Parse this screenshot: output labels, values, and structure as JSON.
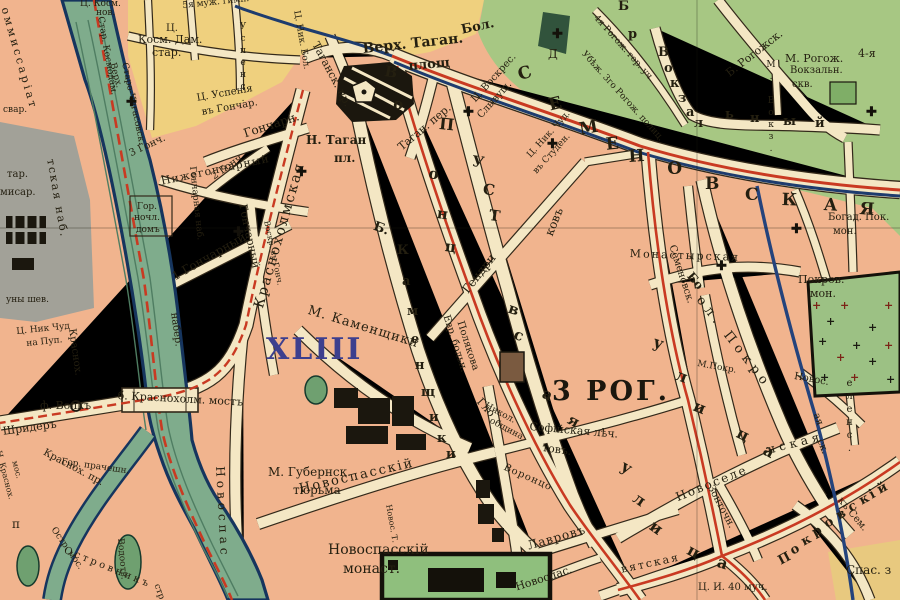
{
  "map_type": "historical city map (Moscow, Taganka area, pre-1917 orthography)",
  "districts": {
    "xliii": "XLIII",
    "rog3": "3 РОГ."
  },
  "icons": {
    "church": "✚",
    "plus": "+"
  },
  "palette": {
    "block_pink": "#F1B48E",
    "street_cream": "#F4E7C4",
    "field_yellow": "#EFD07E",
    "green_area": "#A7C783",
    "grey_area": "#A2A198",
    "water": "#7FAC8C",
    "water_edge": "#16355E",
    "tram_red": "#C93A22",
    "line_blue": "#1E3C6E",
    "building_black": "#1b170e",
    "hospital_brown": "#7a5a40",
    "district_blue": "#3d3f8e"
  },
  "labels": [
    {
      "t": "оммиссаріат",
      "x": 10,
      "y": 6,
      "r": 74,
      "s": 11,
      "ls": 3
    },
    {
      "t": "тская наб.",
      "x": 56,
      "y": 158,
      "r": 80,
      "s": 11,
      "ls": 2
    },
    {
      "t": "свар.",
      "x": 3,
      "y": 106,
      "s": 9
    },
    {
      "t": "тар.",
      "x": 7,
      "y": 170,
      "s": 10
    },
    {
      "t": "мисар.",
      "x": 0,
      "y": 188,
      "s": 10
    },
    {
      "t": "уны шев.",
      "x": 6,
      "y": 296,
      "s": 9
    },
    {
      "t": "Ц. Ник Чуд",
      "x": 16,
      "y": 328,
      "r": -6,
      "s": 9
    },
    {
      "t": "на Пуп.",
      "x": 26,
      "y": 340,
      "r": -6,
      "s": 9
    },
    {
      "t": "ф. Волкъ",
      "x": 40,
      "y": 400,
      "s": 11
    },
    {
      "t": "Шридеръ",
      "x": 2,
      "y": 426,
      "r": -8,
      "s": 11
    },
    {
      "t": "Краснох.",
      "x": 76,
      "y": 328,
      "r": 82,
      "s": 10
    },
    {
      "t": "набер.",
      "x": 178,
      "y": 312,
      "r": 82,
      "s": 10
    },
    {
      "t": "б. Краснохолм. мостъ",
      "x": 118,
      "y": 390,
      "r": 3,
      "s": 11
    },
    {
      "t": "Н. Краснох.",
      "x": 2,
      "y": 450,
      "r": 75,
      "s": 8
    },
    {
      "t": "мос.",
      "x": 18,
      "y": 460,
      "r": 75,
      "s": 8
    },
    {
      "t": "Краснох. пр.",
      "x": 46,
      "y": 448,
      "r": 28,
      "s": 10
    },
    {
      "t": "Гор. прачешн.",
      "x": 62,
      "y": 458,
      "r": 8,
      "s": 9
    },
    {
      "t": "Остр. мос.",
      "x": 56,
      "y": 526,
      "r": 55,
      "s": 9
    },
    {
      "t": "Островникъ",
      "x": 66,
      "y": 546,
      "r": 22,
      "s": 10,
      "ls": 3
    },
    {
      "t": "стр",
      "x": 160,
      "y": 583,
      "r": 70,
      "s": 9
    },
    {
      "t": "п",
      "x": 12,
      "y": 518,
      "s": 12
    },
    {
      "t": "Водоотв.",
      "x": 124,
      "y": 538,
      "r": 85,
      "s": 9
    },
    {
      "t": "Новоспас",
      "x": 226,
      "y": 466,
      "r": 87,
      "s": 12,
      "ls": 4
    },
    {
      "t": "Ц. Косм.",
      "x": 80,
      "y": 0,
      "s": 9
    },
    {
      "t": "нов.",
      "x": 96,
      "y": 9,
      "s": 9
    },
    {
      "t": "Стар. Космодам.",
      "x": 104,
      "y": 16,
      "r": 80,
      "s": 9
    },
    {
      "t": "Ц.",
      "x": 166,
      "y": 24,
      "s": 10
    },
    {
      "t": "Косм. Дам.",
      "x": 138,
      "y": 34,
      "s": 11
    },
    {
      "t": "стар.",
      "x": 152,
      "y": 47,
      "s": 11
    },
    {
      "t": "5я муж. гимн.",
      "x": 182,
      "y": 2,
      "r": -6,
      "s": 9
    },
    {
      "t": "Успенс.",
      "x": 238,
      "y": 22,
      "s": 9,
      "m": "v"
    },
    {
      "t": "Верх.",
      "x": 116,
      "y": 62,
      "r": 75,
      "s": 9
    },
    {
      "t": "Старо-Чигасовск.",
      "x": 128,
      "y": 62,
      "r": 78,
      "s": 9
    },
    {
      "t": "Ц. Успенія",
      "x": 196,
      "y": 94,
      "r": -10,
      "s": 10
    },
    {
      "t": "въ Гончар.",
      "x": 201,
      "y": 108,
      "r": -10,
      "s": 10
    },
    {
      "t": "Гончарн.",
      "x": 242,
      "y": 128,
      "r": -18,
      "s": 12
    },
    {
      "t": "Нижегончарный",
      "x": 160,
      "y": 176,
      "r": -12,
      "s": 11,
      "ls": 1
    },
    {
      "t": "2 Гонч",
      "x": 210,
      "y": 174,
      "r": -35,
      "s": 10
    },
    {
      "t": "1 Гончарный",
      "x": 170,
      "y": 272,
      "r": -30,
      "s": 12
    },
    {
      "t": "Гончарный",
      "x": 248,
      "y": 203,
      "r": 78,
      "s": 11
    },
    {
      "t": "Гончарная наб.",
      "x": 196,
      "y": 166,
      "r": 84,
      "s": 9
    },
    {
      "t": "Гор.",
      "x": 137,
      "y": 203,
      "s": 9
    },
    {
      "t": "ночл.",
      "x": 134,
      "y": 214,
      "s": 9
    },
    {
      "t": "домъ",
      "x": 136,
      "y": 226,
      "s": 9
    },
    {
      "t": "Воскр. въ Гонч.",
      "x": 270,
      "y": 220,
      "r": 78,
      "s": 8
    },
    {
      "t": "3 Гонч.",
      "x": 128,
      "y": 150,
      "r": -25,
      "s": 10
    },
    {
      "t": "Верх. Таган.",
      "x": 362,
      "y": 42,
      "r": -6,
      "s": 14,
      "w": 700
    },
    {
      "t": "площ",
      "x": 408,
      "y": 60,
      "r": -5,
      "s": 13,
      "w": 700
    },
    {
      "t": "Бол.",
      "x": 460,
      "y": 24,
      "r": -12,
      "s": 13,
      "w": 700
    },
    {
      "t": "Таганск. пр.",
      "x": 320,
      "y": 40,
      "r": 62,
      "s": 11
    },
    {
      "t": "Таган. пер.",
      "x": 396,
      "y": 144,
      "r": -40,
      "s": 11
    },
    {
      "t": "Н. Таган",
      "x": 306,
      "y": 134,
      "s": 12,
      "w": 700
    },
    {
      "t": "пл.",
      "x": 334,
      "y": 152,
      "s": 12,
      "w": 700
    },
    {
      "t": "Ц. Ник. Бол.",
      "x": 300,
      "y": 10,
      "r": 80,
      "s": 9
    },
    {
      "t": "Ц. Воскрес.",
      "x": 470,
      "y": 98,
      "r": -48,
      "s": 10
    },
    {
      "t": "Слывущ.",
      "x": 476,
      "y": 114,
      "r": -48,
      "s": 10
    },
    {
      "t": "Ц. Ник. Чуд.",
      "x": 526,
      "y": 154,
      "r": -48,
      "s": 9
    },
    {
      "t": "въ Студен.",
      "x": 532,
      "y": 170,
      "r": -48,
      "s": 9
    },
    {
      "t": "Д",
      "x": 548,
      "y": 48,
      "s": 12
    },
    {
      "t": "Убѣж. 3го Рогож. полиц.",
      "x": 586,
      "y": 50,
      "r": 48,
      "s": 9
    },
    {
      "t": "4я Рогож. гор. уч.",
      "x": 598,
      "y": 14,
      "r": 48,
      "s": 9
    },
    {
      "t": "Б. Рогожск.",
      "x": 724,
      "y": 70,
      "r": -38,
      "s": 11
    },
    {
      "t": "Б",
      "x": 618,
      "y": 0,
      "s": 13,
      "w": 700
    },
    {
      "t": "р",
      "x": 628,
      "y": 28,
      "s": 13,
      "w": 700
    },
    {
      "t": "В",
      "x": 658,
      "y": 46,
      "s": 13,
      "w": 700
    },
    {
      "t": "о",
      "x": 664,
      "y": 62,
      "s": 13,
      "w": 700
    },
    {
      "t": "к",
      "x": 670,
      "y": 77,
      "s": 13,
      "w": 700
    },
    {
      "t": "з",
      "x": 678,
      "y": 92,
      "s": 13,
      "w": 700
    },
    {
      "t": "а",
      "x": 686,
      "y": 106,
      "s": 13,
      "w": 700
    },
    {
      "t": "л",
      "x": 694,
      "y": 117,
      "s": 13,
      "w": 700
    },
    {
      "t": "ь",
      "x": 725,
      "y": 108,
      "s": 13,
      "w": 700
    },
    {
      "t": "н",
      "x": 750,
      "y": 112,
      "s": 13,
      "w": 700
    },
    {
      "t": "ы",
      "x": 783,
      "y": 115,
      "s": 13,
      "w": 700
    },
    {
      "t": "й",
      "x": 815,
      "y": 117,
      "s": 13,
      "w": 700
    },
    {
      "t": "М. Вокз.",
      "x": 766,
      "y": 60,
      "s": 9,
      "m": "v"
    },
    {
      "t": "Вокзальн.",
      "x": 790,
      "y": 66,
      "s": 10
    },
    {
      "t": "скв.",
      "x": 792,
      "y": 80,
      "s": 10
    },
    {
      "t": "М. Рогож.",
      "x": 785,
      "y": 53,
      "s": 11
    },
    {
      "t": "4-я",
      "x": 858,
      "y": 48,
      "s": 11
    },
    {
      "t": "С",
      "x": 516,
      "y": 68,
      "r": -18,
      "s": 17,
      "w": 700
    },
    {
      "t": "Е",
      "x": 547,
      "y": 98,
      "r": -14,
      "s": 17,
      "w": 700
    },
    {
      "t": "М",
      "x": 578,
      "y": 122,
      "r": -10,
      "s": 17,
      "w": 700
    },
    {
      "t": "Е",
      "x": 605,
      "y": 137,
      "r": -6,
      "s": 17,
      "w": 700
    },
    {
      "t": "Н",
      "x": 628,
      "y": 149,
      "r": -4,
      "s": 17,
      "w": 700
    },
    {
      "t": "О",
      "x": 667,
      "y": 161,
      "r": -2,
      "s": 17,
      "w": 700
    },
    {
      "t": "В",
      "x": 705,
      "y": 176,
      "s": 17,
      "w": 700
    },
    {
      "t": "С",
      "x": 745,
      "y": 187,
      "s": 17,
      "w": 700
    },
    {
      "t": "К",
      "x": 782,
      "y": 192,
      "r": 2,
      "s": 17,
      "w": 700
    },
    {
      "t": "А",
      "x": 824,
      "y": 197,
      "r": 3,
      "s": 17,
      "w": 700
    },
    {
      "t": "Я",
      "x": 860,
      "y": 201,
      "r": 4,
      "s": 17,
      "w": 700
    },
    {
      "t": "В",
      "x": 386,
      "y": 64,
      "r": 10,
      "s": 15,
      "w": 700
    },
    {
      "t": "о",
      "x": 395,
      "y": 96,
      "r": 12,
      "s": 15,
      "w": 700
    },
    {
      "t": "о",
      "x": 430,
      "y": 166,
      "r": 10,
      "s": 15,
      "w": 700
    },
    {
      "t": "н",
      "x": 438,
      "y": 206,
      "r": 8,
      "s": 15,
      "w": 700
    },
    {
      "t": "ц",
      "x": 446,
      "y": 239,
      "r": 8,
      "s": 15,
      "w": 700
    },
    {
      "t": "в",
      "x": 511,
      "y": 301,
      "r": 18,
      "s": 15,
      "w": 700
    },
    {
      "t": "с",
      "x": 517,
      "y": 327,
      "r": 20,
      "s": 15,
      "w": 700
    },
    {
      "t": "Воронцо",
      "x": 506,
      "y": 463,
      "r": 24,
      "s": 10,
      "ls": 1
    },
    {
      "t": "у",
      "x": 626,
      "y": 458,
      "r": 30,
      "s": 16,
      "w": 700
    },
    {
      "t": "л",
      "x": 639,
      "y": 490,
      "r": 34,
      "s": 16,
      "w": 700
    },
    {
      "t": "и",
      "x": 656,
      "y": 518,
      "r": 36,
      "s": 16,
      "w": 700
    },
    {
      "t": "ц",
      "x": 692,
      "y": 542,
      "r": 28,
      "s": 16,
      "w": 700
    },
    {
      "t": "а",
      "x": 720,
      "y": 554,
      "r": 18,
      "s": 16,
      "w": 700
    },
    {
      "t": "П",
      "x": 440,
      "y": 116,
      "r": 6,
      "s": 16,
      "w": 700
    },
    {
      "t": "У",
      "x": 473,
      "y": 154,
      "r": 8,
      "s": 15,
      "w": 700
    },
    {
      "t": "С",
      "x": 484,
      "y": 182,
      "r": 8,
      "s": 15,
      "w": 700
    },
    {
      "t": "Т",
      "x": 490,
      "y": 208,
      "r": 8,
      "s": 15,
      "w": 700
    },
    {
      "t": "а",
      "x": 546,
      "y": 386,
      "r": 24,
      "s": 15,
      "w": 700
    },
    {
      "t": "я",
      "x": 572,
      "y": 412,
      "r": 28,
      "s": 15,
      "w": 700
    },
    {
      "t": "Гендри",
      "x": 460,
      "y": 288,
      "r": -52,
      "s": 12
    },
    {
      "t": "ковъ",
      "x": 543,
      "y": 233,
      "r": -68,
      "s": 12
    },
    {
      "t": "Гло",
      "x": 483,
      "y": 396,
      "r": 48,
      "s": 11
    },
    {
      "t": "товъ.",
      "x": 543,
      "y": 442,
      "r": 8,
      "s": 11
    },
    {
      "t": "Никол.",
      "x": 487,
      "y": 402,
      "r": 28,
      "s": 9
    },
    {
      "t": "община",
      "x": 492,
      "y": 417,
      "r": 28,
      "s": 9
    },
    {
      "t": "Софійская лѣч.",
      "x": 530,
      "y": 421,
      "r": 5,
      "s": 11
    },
    {
      "t": "Евр. больн.",
      "x": 450,
      "y": 314,
      "r": 72,
      "s": 10
    },
    {
      "t": "Полякова",
      "x": 464,
      "y": 320,
      "r": 72,
      "s": 10
    },
    {
      "t": "М. Каменщики",
      "x": 310,
      "y": 304,
      "r": 17,
      "s": 13,
      "ls": 1
    },
    {
      "t": "Б.",
      "x": 376,
      "y": 220,
      "r": 20,
      "s": 13,
      "w": 700
    },
    {
      "t": "К",
      "x": 397,
      "y": 244,
      "s": 13,
      "w": 700
    },
    {
      "t": "а",
      "x": 402,
      "y": 275,
      "s": 13,
      "w": 700
    },
    {
      "t": "м",
      "x": 407,
      "y": 305,
      "s": 13,
      "w": 700
    },
    {
      "t": "е",
      "x": 411,
      "y": 333,
      "s": 13,
      "w": 700
    },
    {
      "t": "н",
      "x": 415,
      "y": 359,
      "s": 13,
      "w": 700
    },
    {
      "t": "щ",
      "x": 421,
      "y": 386,
      "s": 13,
      "w": 700
    },
    {
      "t": "и",
      "x": 429,
      "y": 411,
      "s": 13,
      "w": 700
    },
    {
      "t": "к",
      "x": 437,
      "y": 432,
      "s": 13,
      "w": 700
    },
    {
      "t": "и",
      "x": 446,
      "y": 448,
      "s": 13,
      "w": 700
    },
    {
      "t": "Краснохолмская",
      "x": 252,
      "y": 306,
      "r": -74,
      "s": 14,
      "ls": 2
    },
    {
      "t": "Семеновск.",
      "x": 676,
      "y": 244,
      "r": 72,
      "s": 10
    },
    {
      "t": "Монастырская",
      "x": 630,
      "y": 248,
      "r": 2,
      "s": 11,
      "ls": 2
    },
    {
      "t": "Бо",
      "x": 694,
      "y": 270,
      "r": 50,
      "s": 12,
      "w": 700
    },
    {
      "t": "ол. Покро",
      "x": 704,
      "y": 294,
      "r": 52,
      "s": 13,
      "ls": 5
    },
    {
      "t": "М.Покр.",
      "x": 698,
      "y": 360,
      "r": 10,
      "s": 9
    },
    {
      "t": "у",
      "x": 656,
      "y": 334,
      "r": 18,
      "s": 16,
      "w": 700
    },
    {
      "t": "л",
      "x": 679,
      "y": 367,
      "r": 20,
      "s": 16,
      "w": 700
    },
    {
      "t": "и",
      "x": 697,
      "y": 398,
      "r": 22,
      "s": 16,
      "w": 700
    },
    {
      "t": "ц",
      "x": 741,
      "y": 425,
      "r": 26,
      "s": 16,
      "w": 700
    },
    {
      "t": "а",
      "x": 768,
      "y": 442,
      "r": 28,
      "s": 16,
      "w": 700
    },
    {
      "t": "Покров.",
      "x": 798,
      "y": 274,
      "s": 11
    },
    {
      "t": "мон.",
      "x": 810,
      "y": 288,
      "s": 11
    },
    {
      "t": "Богад. Пок.",
      "x": 828,
      "y": 213,
      "s": 10
    },
    {
      "t": "мон.",
      "x": 833,
      "y": 227,
      "s": 10
    },
    {
      "t": "Новос.",
      "x": 795,
      "y": 372,
      "r": 10,
      "s": 10
    },
    {
      "t": "еленс.",
      "x": 844,
      "y": 378,
      "s": 10,
      "m": "v"
    },
    {
      "t": "ая",
      "x": 820,
      "y": 412,
      "r": 70,
      "s": 10
    },
    {
      "t": "ск.",
      "x": 824,
      "y": 438,
      "r": 70,
      "s": 10
    },
    {
      "t": "Новоселе",
      "x": 674,
      "y": 492,
      "r": -22,
      "s": 12,
      "ls": 2
    },
    {
      "t": "нская",
      "x": 766,
      "y": 444,
      "r": -14,
      "s": 12,
      "ls": 4
    },
    {
      "t": "Зонточн.",
      "x": 714,
      "y": 484,
      "r": 62,
      "s": 10
    },
    {
      "t": "Лавровъ",
      "x": 526,
      "y": 540,
      "r": -16,
      "s": 12,
      "ls": 1
    },
    {
      "t": "Новоспасскій",
      "x": 298,
      "y": 483,
      "r": -13,
      "s": 13,
      "ls": 2
    },
    {
      "t": "Новос. Т.",
      "x": 392,
      "y": 504,
      "r": 80,
      "s": 8
    },
    {
      "t": "М. Губернск.",
      "x": 268,
      "y": 466,
      "s": 12
    },
    {
      "t": "тюрьма",
      "x": 293,
      "y": 484,
      "s": 12
    },
    {
      "t": "Новоспасскій",
      "x": 328,
      "y": 543,
      "s": 14
    },
    {
      "t": "монаст.",
      "x": 343,
      "y": 562,
      "s": 14
    },
    {
      "t": "Новоспас.",
      "x": 514,
      "y": 582,
      "r": -18,
      "s": 11
    },
    {
      "t": "вятская",
      "x": 620,
      "y": 564,
      "r": -12,
      "s": 11,
      "ls": 2
    },
    {
      "t": "Ц. И. 40 муч.",
      "x": 698,
      "y": 583,
      "s": 10
    },
    {
      "t": "Спас. з",
      "x": 846,
      "y": 564,
      "s": 12
    },
    {
      "t": "къ Сем.",
      "x": 843,
      "y": 496,
      "r": 50,
      "s": 10
    },
    {
      "t": "П",
      "x": 776,
      "y": 556,
      "r": -28,
      "s": 13,
      "w": 700
    },
    {
      "t": "о",
      "x": 788,
      "y": 546,
      "r": -28,
      "s": 13,
      "w": 700
    },
    {
      "t": "к",
      "x": 799,
      "y": 537,
      "r": -28,
      "s": 13,
      "w": 700
    },
    {
      "t": "р",
      "x": 810,
      "y": 528,
      "r": -28,
      "s": 13,
      "w": 700
    },
    {
      "t": "о",
      "x": 822,
      "y": 519,
      "r": -28,
      "s": 13,
      "w": 700
    },
    {
      "t": "в",
      "x": 834,
      "y": 511,
      "r": -28,
      "s": 13,
      "w": 700
    },
    {
      "t": "с",
      "x": 846,
      "y": 503,
      "r": -28,
      "s": 13,
      "w": 700
    },
    {
      "t": "к",
      "x": 857,
      "y": 496,
      "r": -28,
      "s": 13,
      "w": 700
    },
    {
      "t": "і",
      "x": 867,
      "y": 490,
      "r": -28,
      "s": 13,
      "w": 700
    },
    {
      "t": "й",
      "x": 875,
      "y": 485,
      "r": -28,
      "s": 13,
      "w": 700
    }
  ],
  "crosses": [
    {
      "x": 126,
      "y": 96
    },
    {
      "x": 233,
      "y": 226
    },
    {
      "x": 296,
      "y": 166
    },
    {
      "x": 463,
      "y": 106
    },
    {
      "x": 547,
      "y": 138
    },
    {
      "x": 791,
      "y": 223
    },
    {
      "x": 866,
      "y": 106
    },
    {
      "x": 716,
      "y": 260
    },
    {
      "x": 552,
      "y": 28
    }
  ],
  "monastery_pluses": [
    {
      "x": 812,
      "y": 300,
      "c": "#7c2417"
    },
    {
      "x": 826,
      "y": 316,
      "c": "#1b1b12"
    },
    {
      "x": 840,
      "y": 300,
      "c": "#7c2417"
    },
    {
      "x": 818,
      "y": 336,
      "c": "#1b1b12"
    },
    {
      "x": 836,
      "y": 352,
      "c": "#7c2417"
    },
    {
      "x": 852,
      "y": 340,
      "c": "#1b1b12"
    },
    {
      "x": 868,
      "y": 322,
      "c": "#1b1b12"
    },
    {
      "x": 884,
      "y": 300,
      "c": "#7c2417"
    },
    {
      "x": 868,
      "y": 356,
      "c": "#1b1b12"
    },
    {
      "x": 886,
      "y": 374,
      "c": "#1b1b12"
    },
    {
      "x": 850,
      "y": 372,
      "c": "#7c2417"
    },
    {
      "x": 820,
      "y": 372,
      "c": "#1b1b12"
    },
    {
      "x": 884,
      "y": 340,
      "c": "#7c2417"
    }
  ]
}
